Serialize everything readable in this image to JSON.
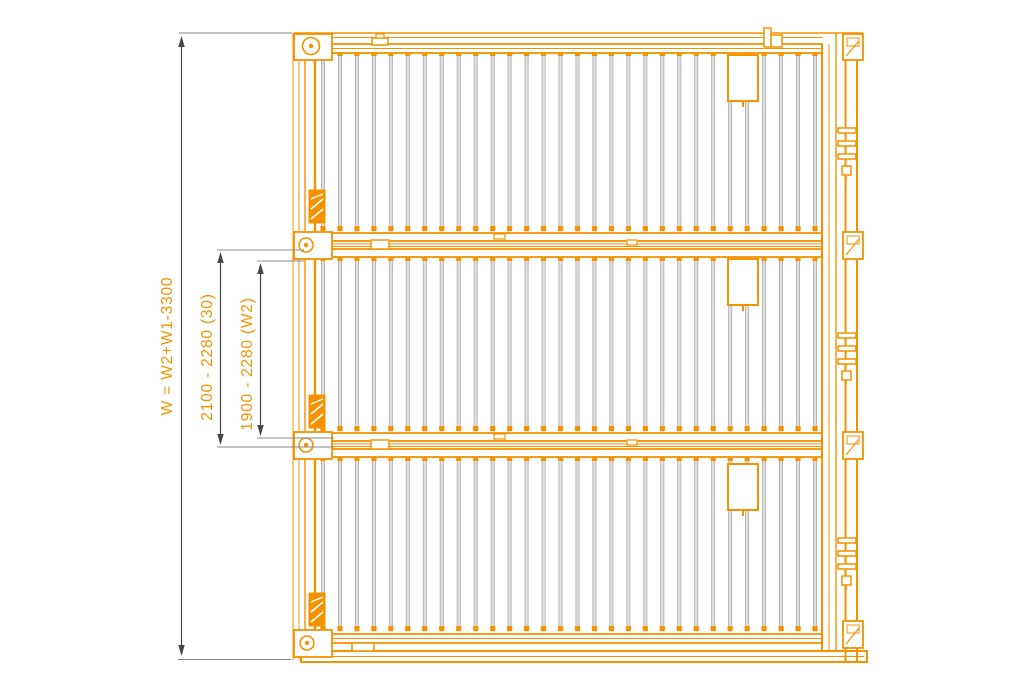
{
  "drawing": {
    "type": "technical-plan-view",
    "subject": "foldable container panels with corrugated sheets, three stacked panels",
    "panels": {
      "count": 3,
      "corrugations_per_panel": 30
    }
  },
  "colors": {
    "line": "#F49200",
    "corrugation_fill": "#DEDEDE",
    "corrugation_edge": "#A6A6A6",
    "dimension_line": "#474747",
    "extension_line": "#8a8a8a",
    "label": "#F49200",
    "background": "#FFFFFF"
  },
  "dimensions": [
    {
      "id": "overall-width",
      "label": "W = W2+W1-3300"
    },
    {
      "id": "panel-outer-width",
      "label": "2100 - 2280 (30)"
    },
    {
      "id": "panel-inner-width",
      "label": "1900 - 2280 (W2)"
    }
  ]
}
